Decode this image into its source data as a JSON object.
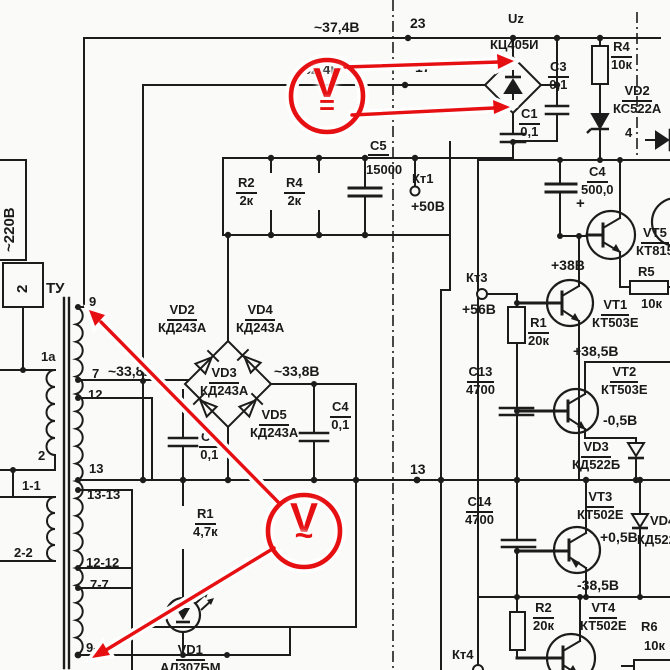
{
  "annotations": {
    "accent_color": "#e60f12",
    "dc_probe": {
      "letter": "V",
      "mode": "="
    },
    "ac_probe": {
      "letter": "V",
      "mode": "~"
    }
  },
  "top": {
    "vac1": "~37,4В",
    "node23": "23",
    "uz": "Uz",
    "bridge": "КЦ405И",
    "vac2": "~32,4В",
    "node17": "17",
    "c3": "C3",
    "c3v": "0,1",
    "c1": "C1",
    "c1v": "0,1",
    "r4": "R4",
    "r4v": "10к",
    "vd2": "VD2",
    "vd2v": "КС522А",
    "pin4": "4"
  },
  "filter": {
    "r2": "R2",
    "r2v": "2к",
    "r4": "R4",
    "r4v": "2к",
    "c5": "C5",
    "c5v": "15000",
    "kt1": "Кт1",
    "kt1v": "+50В"
  },
  "mains": {
    "v220": "~220В",
    "sock": "2",
    "tu": "ТУ"
  },
  "taps": {
    "t1a": "1а",
    "t2": "2",
    "t11": "1-1",
    "t22": "2-2",
    "t9": "9",
    "t7": "7",
    "t12": "12",
    "t13": "13",
    "t1313": "13-13",
    "t1212": "12-12",
    "t77": "7-7",
    "t99": "9-9"
  },
  "bridge2": {
    "vd2": "VD2",
    "vd2v": "КД243А",
    "vd4": "VD4",
    "vd4v": "КД243А",
    "vd3": "VD3",
    "vd3v": "КД243А",
    "vd5": "VD5",
    "vd5v": "КД243А",
    "vacl": "~33,8В",
    "vacr": "~33,8В",
    "c3": "C3",
    "c3v": "0,1",
    "c4": "C4",
    "c4v": "0,1",
    "r1": "R1",
    "r1v": "4,7к",
    "vd1": "VD1",
    "vd1v": "АЛ307БМ",
    "node13": "13"
  },
  "reg": {
    "c4": "C4",
    "c4v": "500,0",
    "plus": "+",
    "kt3": "Кт3",
    "v56": "+56В",
    "r1": "R1",
    "r1v": "20к",
    "v38": "+38В",
    "vt1": "VT1",
    "vt1v": "КТ503Е",
    "v385": "+38,5В",
    "vt5": "VT5",
    "vt5v": "КТ815",
    "r5": "R5",
    "r5v": "10к",
    "c13": "C13",
    "c13v": "4700",
    "vt2": "VT2",
    "vt2v": "КТ503Е",
    "vm05": "-0,5В",
    "vd3": "VD3",
    "vd3v": "КД522Б",
    "c14": "C14",
    "c14v": "4700",
    "vt3": "VT3",
    "vt3v": "КТ502Е",
    "vp05": "+0,5В",
    "vd4": "VD4",
    "vd4v": "КД522",
    "vm385": "-38,5В",
    "r2": "R2",
    "r2v": "20к",
    "vt4": "VT4",
    "vt4v": "КТ502Е",
    "r6": "R6",
    "r6v": "10к",
    "kt4": "Кт4"
  }
}
